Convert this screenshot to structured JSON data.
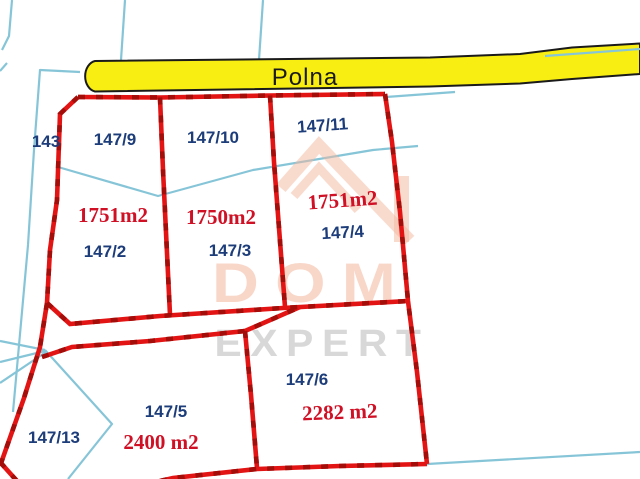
{
  "road": {
    "label": "Polna"
  },
  "watermark": {
    "title": "DOM",
    "subtitle": "EXPERT"
  },
  "parcels": {
    "p143": {
      "id": "143"
    },
    "p147_9": {
      "id": "147/9"
    },
    "p147_10": {
      "id": "147/10"
    },
    "p147_11": {
      "id": "147/11"
    },
    "p147_2": {
      "id": "147/2",
      "area": "1751m2"
    },
    "p147_3": {
      "id": "147/3",
      "area": "1750m2"
    },
    "p147_4": {
      "id": "147/4",
      "area": "1751m2"
    },
    "p147_5": {
      "id": "147/5",
      "area": "2400 m2"
    },
    "p147_6": {
      "id": "147/6",
      "area": "2282 m2"
    },
    "p147_13": {
      "id": "147/13"
    }
  },
  "colors": {
    "background": "#ffffff",
    "boundary_red": "#e31414",
    "boundary_red_dark": "#a30d0a",
    "cadastral_cyan": "#86c5d8",
    "road_yellow": "#f8ee12",
    "road_outline": "#1a1a1a",
    "parcel_label_navy": "#1d3d7a",
    "area_label_red": "#d01025",
    "watermark_peach": "#f3b79e",
    "watermark_gray": "#bfbfbf"
  }
}
